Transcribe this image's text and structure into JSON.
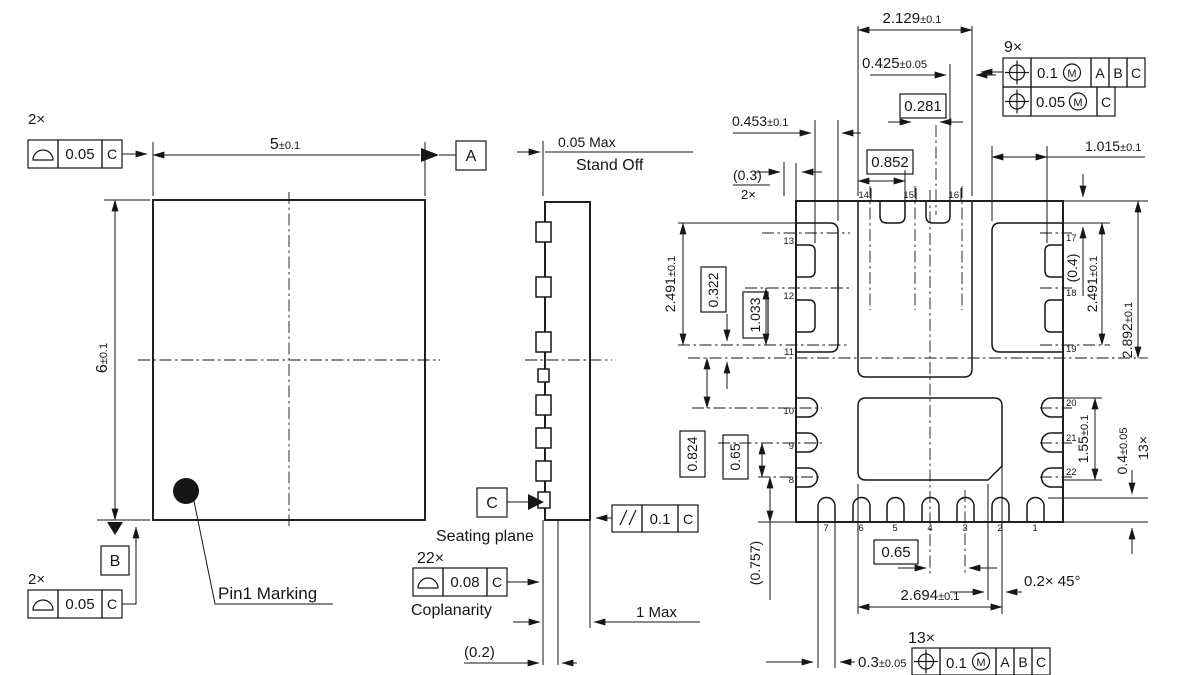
{
  "colors": {
    "ink": "#161616",
    "background": "#ffffff",
    "pin1_dot": "#161616"
  },
  "symbols": {
    "profile_of_surface": "half-dome segment",
    "true_position": "circle with cross",
    "parallelism": "double slash",
    "material_condition": "circled M",
    "datum_target": "filled triangle"
  },
  "tv": {
    "count_top": "2×",
    "fcf_top": {
      "value": "0.05",
      "datum": "C"
    },
    "width_v": "5",
    "width_t": "±0.1",
    "height_v": "6",
    "height_t": "±0.1",
    "datum_a": "A",
    "datum_b": "B",
    "count_bot": "2×",
    "fcf_bot": {
      "value": "0.05",
      "datum": "C"
    },
    "pin1_label": "Pin1 Marking"
  },
  "sv": {
    "standoff1": "0.05 Max",
    "standoff2": "Stand Off",
    "seating": "Seating plane",
    "datum_c": "C",
    "par_val": "0.1",
    "par_datum": "C",
    "cop_count": "22×",
    "cop_val": "0.08",
    "cop_datum": "C",
    "cop_label": "Coplanarity",
    "hmax": "1 Max",
    "t02": "(0.2)"
  },
  "bv": {
    "d2129_v": "2.129",
    "d2129_t": "±0.1",
    "d0425_v": "0.425",
    "d0425_t": "±0.05",
    "b0281": "0.281",
    "b0852": "0.852",
    "d0453_v": "0.453",
    "d0453_t": "±0.1",
    "r03": "(0.3)",
    "c2x": "2×",
    "d1015_v": "1.015",
    "d1015_t": "±0.1",
    "l2491_v": "2.491",
    "l2491_t": "±0.1",
    "b0322": "0.322",
    "b1033": "1.033",
    "r04": "(0.4)",
    "r2491_v": "2.491",
    "r2491_t": "±0.1",
    "d2892_v": "2.892",
    "d2892_t": "±0.1",
    "b0824": "0.824",
    "b065l": "0.65",
    "d155_v": "1.55",
    "d155_t": "±0.1",
    "d04_v": "0.4",
    "d04_t": "±0.05",
    "c13xr": "13×",
    "r0757": "(0.757)",
    "b065b": "0.65",
    "chamfer": "0.2× 45°",
    "d2694_v": "2.694",
    "d2694_t": "±0.1",
    "d03_v": "0.3",
    "d03_t": "±0.05",
    "c9x": "9×",
    "fcf9_r1": {
      "val": "0.1",
      "mod": "M",
      "d1": "A",
      "d2": "B",
      "d3": "C"
    },
    "fcf9_r2": {
      "val": "0.05",
      "mod": "M",
      "d1": "C"
    },
    "c13xb": "13×",
    "fcf13": {
      "val": "0.1",
      "mod": "M",
      "d1": "A",
      "d2": "B",
      "d3": "C"
    },
    "pins": {
      "top": [
        "14",
        "15",
        "16"
      ],
      "lu": [
        "13",
        "12",
        "11"
      ],
      "ll": [
        "10",
        "9",
        "8"
      ],
      "ru": [
        "17",
        "18",
        "19"
      ],
      "rl": [
        "20",
        "21",
        "22"
      ],
      "bot": [
        "7",
        "6",
        "5",
        "4",
        "3",
        "2",
        "1"
      ]
    }
  }
}
